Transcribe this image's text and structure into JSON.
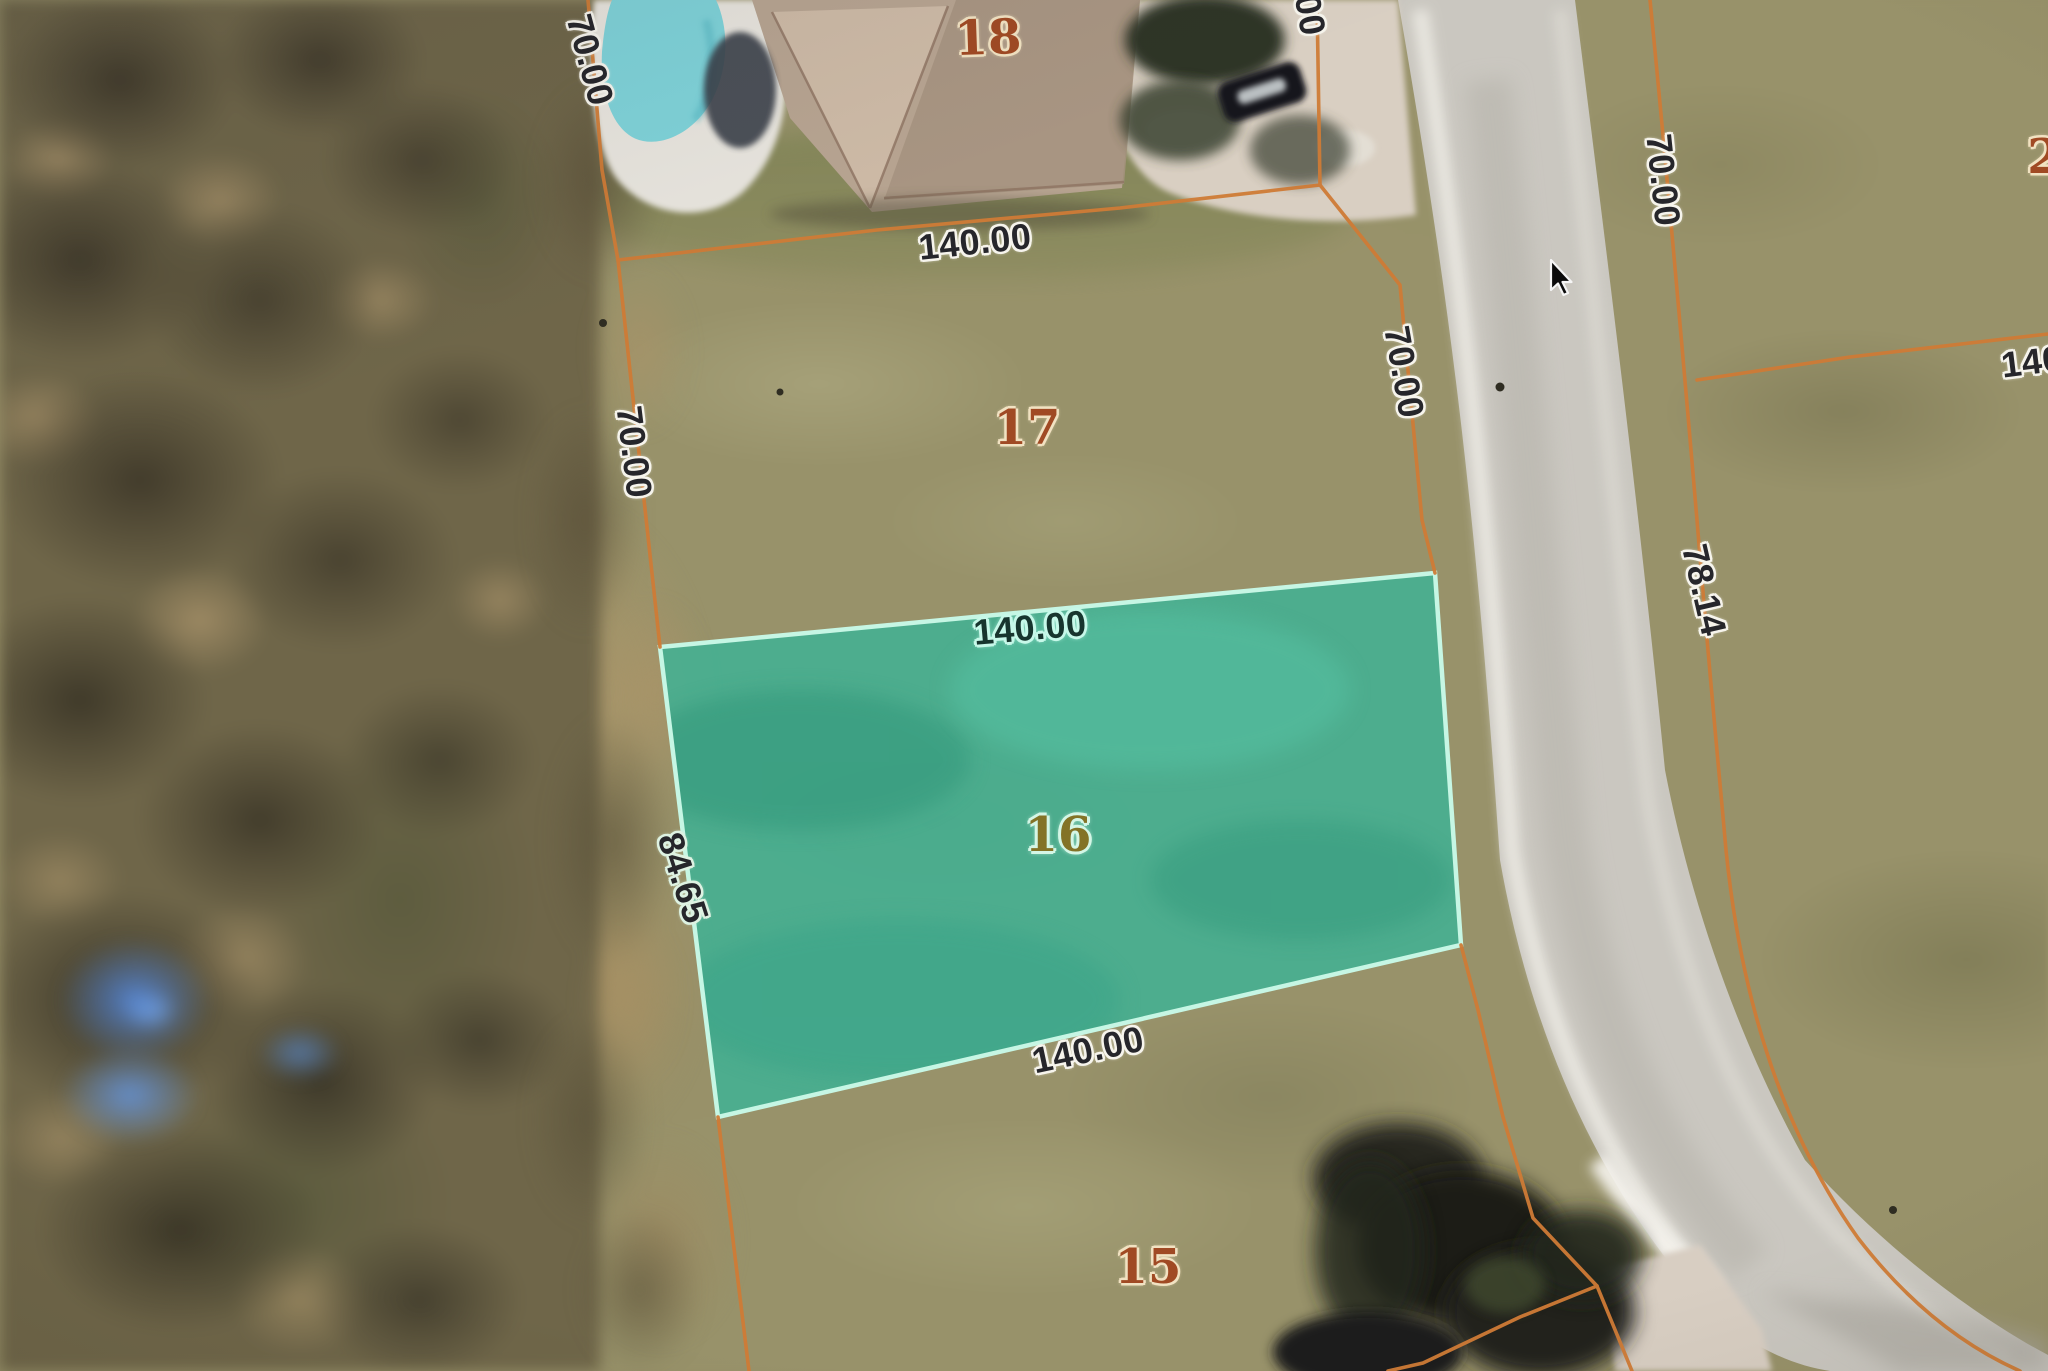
{
  "map": {
    "view": "aerial-parcel-map",
    "selected_parcel": "16",
    "cursor_visible": true
  },
  "labels": {
    "lots": [
      {
        "id": "lot-18",
        "text": "18"
      },
      {
        "id": "lot-17",
        "text": "17"
      },
      {
        "id": "lot-16",
        "text": "16"
      },
      {
        "id": "lot-15",
        "text": "15"
      },
      {
        "id": "lot-2-partial",
        "text": "2"
      }
    ],
    "dims": [
      {
        "id": "dim-rear-70",
        "text": "70.00"
      },
      {
        "id": "dim-top-partial",
        "text": "00"
      },
      {
        "id": "dim-lot17-front",
        "text": "140.00"
      },
      {
        "id": "dim-lot17-left",
        "text": "70.00"
      },
      {
        "id": "dim-lot17-right",
        "text": "70.00"
      },
      {
        "id": "dim-road-right",
        "text": "70.00"
      },
      {
        "id": "dim-lot16-top",
        "text": "140.00"
      },
      {
        "id": "dim-lot16-left",
        "text": "84.65"
      },
      {
        "id": "dim-lot16-bottom",
        "text": "140.00"
      },
      {
        "id": "dim-right-block",
        "text": "78.14"
      },
      {
        "id": "dim-right-partial",
        "text": "140"
      }
    ]
  },
  "colors": {
    "parcel_line": "#cf7b36",
    "highlight_fill": "#3fae8f",
    "highlight_border": "#c6f6e4",
    "lot_number_text": "#a04a24",
    "dimension_text": "#26262b",
    "road_surface": "#cac7c0",
    "pool_water": "#7fd2d8"
  }
}
